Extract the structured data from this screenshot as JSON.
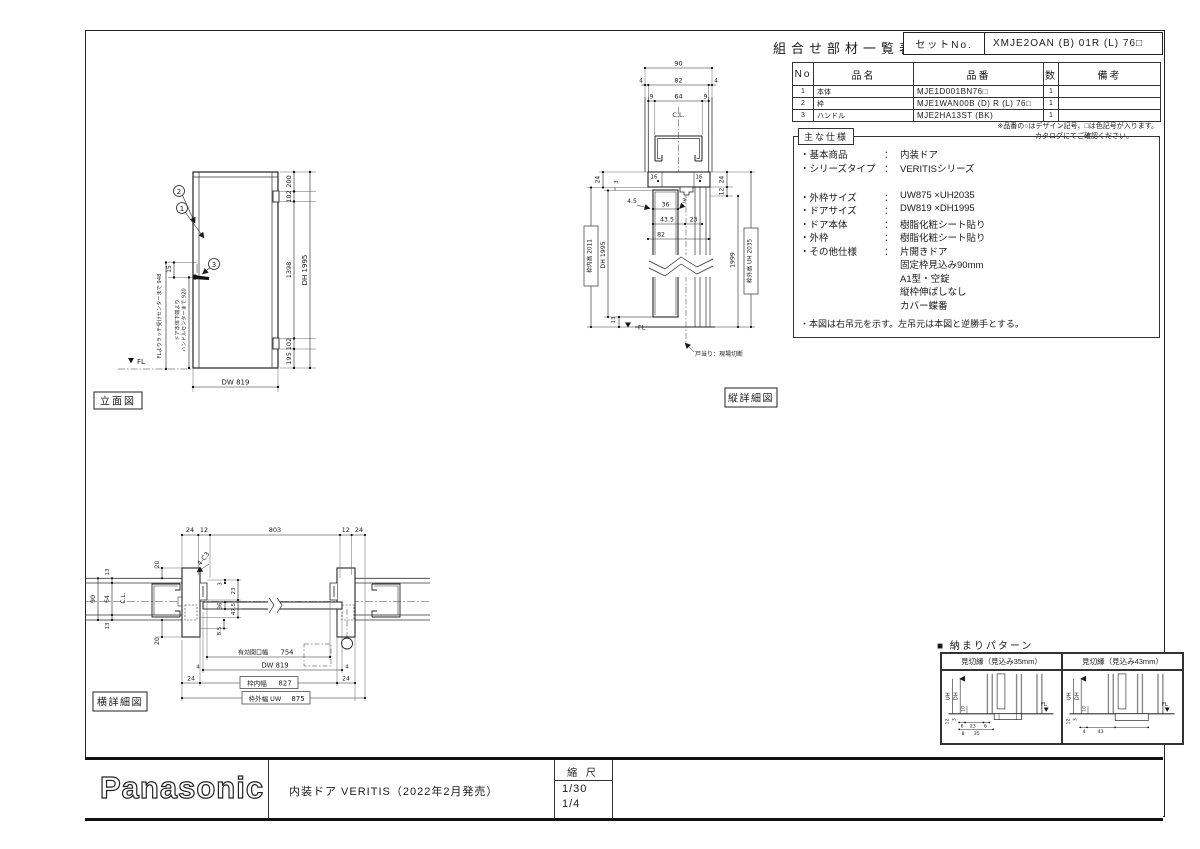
{
  "sheet": {
    "parts_list": {
      "title": "組合せ部材一覧表",
      "set_no_label": "セットNo.",
      "set_no_value": "XMJE2OAN (B) 01R (L) 76□",
      "col_no": "No",
      "col_name": "品名",
      "col_part": "品番",
      "col_qty": "数",
      "col_remarks": "備考",
      "rows": [
        {
          "no": "1",
          "name": "本体",
          "part": "MJE1D001BN76□",
          "qty": "1",
          "remarks": ""
        },
        {
          "no": "2",
          "name": "枠",
          "part": "MJE1WAN00B (D) R (L) 76□",
          "qty": "1",
          "remarks": ""
        },
        {
          "no": "3",
          "name": "ハンドル",
          "part": "MJE2HA13ST (BK)",
          "qty": "1",
          "remarks": ""
        }
      ],
      "note1": "※品番の○はデザイン記号、□は色記号が入ります。",
      "note2": "カタログにてご確認ください。"
    },
    "specs": {
      "title": "主な仕様",
      "items": [
        {
          "label": "・基本商品",
          "sep": "：",
          "value": "内装ドア"
        },
        {
          "label": "・シリーズタイプ",
          "sep": "：",
          "value": "VERITISシリーズ"
        },
        {
          "label": "・外枠サイズ",
          "sep": "：",
          "value": "UW875 ×UH2035"
        },
        {
          "label": "・ドアサイズ",
          "sep": "：",
          "value": "DW819 ×DH1995"
        },
        {
          "label": "・ドア本体",
          "sep": "：",
          "value": "樹脂化粧シート貼り"
        },
        {
          "label": "・外枠",
          "sep": "：",
          "value": "樹脂化粧シート貼り"
        },
        {
          "label": "・その他仕様",
          "sep": "：",
          "value": "片開きドア"
        },
        {
          "label": "",
          "sep": "",
          "value": "固定枠見込み90mm"
        },
        {
          "label": "",
          "sep": "",
          "value": "A1型・空錠"
        },
        {
          "label": "",
          "sep": "",
          "value": "縦枠伸ばしなし"
        },
        {
          "label": "",
          "sep": "",
          "value": "カバー蝶番"
        }
      ],
      "note": "・本図は右吊元を示す。左吊元は本図と逆勝手とする。"
    },
    "elevation": {
      "caption": "立面図",
      "callout_1": "1",
      "callout_2": "2",
      "callout_3": "3",
      "dim_top": "200",
      "dim_hinge_top": "102",
      "dim_mid": "1398",
      "dim_hinge_bot": "102",
      "dim_bot": "195",
      "dim_height": "DH 1995",
      "dim_width": "DW 819",
      "dim_latch": "15",
      "note_latch": "FLよりラッチ受けセンターまで 948",
      "note_handle_1": "ドア本体下端より",
      "note_handle_2": "ハンドルセンターまで 920",
      "fl": "FL"
    },
    "vertical_detail": {
      "caption": "縦詳細図",
      "cl": "C.L.",
      "fl": "FL",
      "dim_90": "90",
      "dim_4l": "4",
      "dim_82": "82",
      "dim_4r": "4",
      "dim_9l": "9",
      "dim_64": "64",
      "dim_9r": "9",
      "dim_16l": "16",
      "dim_16r": "16",
      "dim_24l": "24",
      "dim_3": "3",
      "label_inner": "枠内高 2011",
      "dim_dh": "DH 1995",
      "dim_13": "13",
      "dim_24r": "24",
      "dim_12": "12",
      "dim_1999": "1999",
      "label_outer": "枠外高 UH 2035",
      "dim_45": "4.5",
      "dim_36": "36",
      "dim_3b": "3",
      "dim_435": "43.5",
      "dim_23": "23",
      "dim_82b": "82",
      "note_stop": "戸当り：現場切断"
    },
    "horizontal_detail": {
      "caption": "横詳細図",
      "cl": "C.L.",
      "dim_24l": "24",
      "dim_12l": "12",
      "dim_803": "803",
      "dim_12r": "12",
      "dim_24r": "24",
      "note_corner": "4-C3",
      "dim_90": "90",
      "dim_64": "64",
      "dim_13t": "13",
      "dim_13b": "13",
      "dim_20t": "20",
      "dim_20b": "20",
      "dim_3": "3",
      "dim_23": "23",
      "dim_36": "36",
      "dim_475": "47.5",
      "dim_85": "8.5",
      "opening_label": "有効開口幅",
      "opening_value": "754",
      "dim_dw": "DW 819",
      "dim_4l": "4",
      "dim_4r": "4",
      "inner_label": "枠内幅",
      "inner_value": "827",
      "dim_24bl": "24",
      "dim_24br": "24",
      "outer_label": "枠外幅 UW",
      "outer_value": "875"
    },
    "patterns": {
      "title": "■ 納まりパターン",
      "p35": {
        "header": "見切縁（見込み35mm）",
        "uh": "UH",
        "dh": "DH",
        "d10": "10",
        "fl": "FL",
        "d12": "12",
        "d3": "3",
        "d6l": "6",
        "d23": "23",
        "d6r": "6",
        "d8": "8",
        "d35": "35"
      },
      "p43": {
        "header": "見切縁（見込み43mm）",
        "uh": "UH",
        "dh": "DH",
        "d10": "10",
        "fl": "FL",
        "d12": "12",
        "d3": "3",
        "d4": "4",
        "d43": "43"
      }
    },
    "title_block": {
      "brand": "Panasonic",
      "product": "内装ドア VERITIS（2022年2月発売）",
      "scale_label": "縮 尺",
      "scale_1": "1/30",
      "scale_2": "1/4"
    }
  }
}
